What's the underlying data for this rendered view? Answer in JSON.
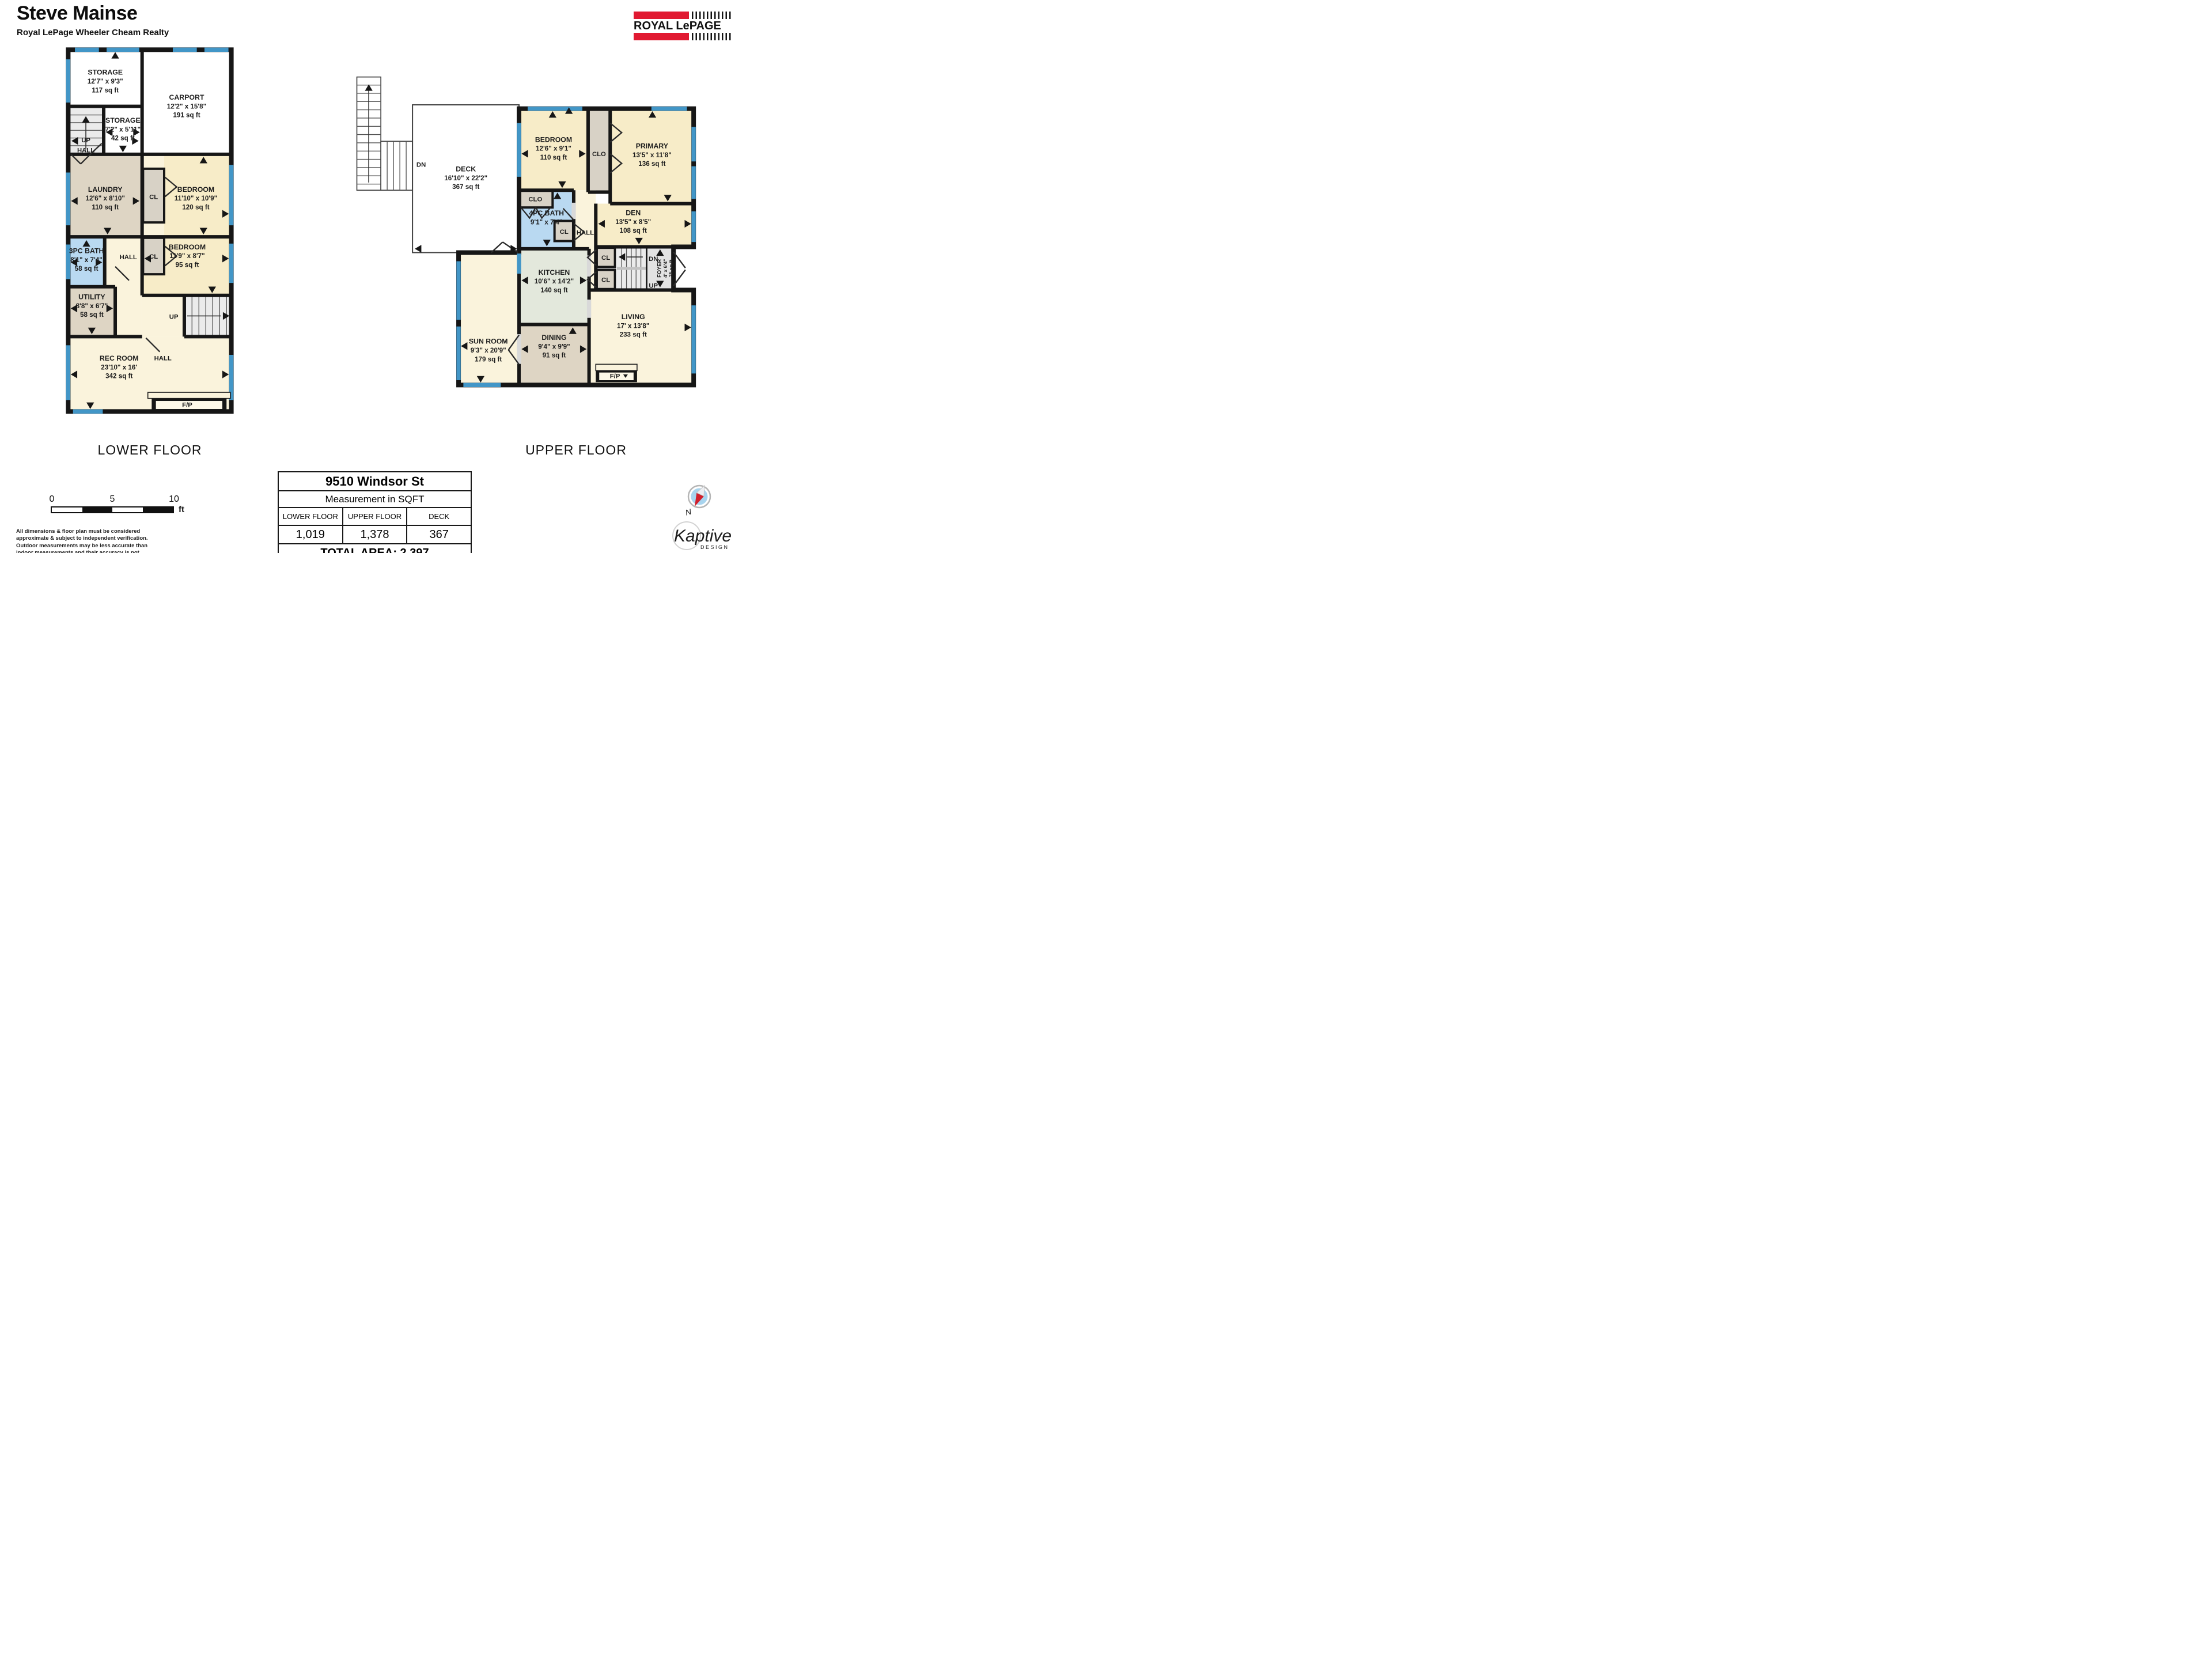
{
  "header": {
    "agent": "Steve Mainse",
    "brokerage": "Royal LePage Wheeler Cheam Realty"
  },
  "brand": {
    "logo": "ROYAL LePAGE",
    "red": "#e11931"
  },
  "lower": {
    "caption": "LOWER FLOOR",
    "storage1": {
      "name": "STORAGE",
      "dims": "12'7\" x 9'3\"",
      "area": "117 sq ft"
    },
    "carport": {
      "name": "CARPORT",
      "dims": "12'2\" x 15'8\"",
      "area": "191 sq ft"
    },
    "storage2": {
      "name": "STORAGE",
      "dims": "7'2\" x 5'11\"",
      "area": "42 sq ft"
    },
    "laundry": {
      "name": "LAUNDRY",
      "dims": "12'6\" x 8'10\"",
      "area": "110 sq ft"
    },
    "bedroom1": {
      "name": "BEDROOM",
      "dims": "11'10\" x 10'9\"",
      "area": "120 sq ft"
    },
    "bath": {
      "name": "3PC BATH",
      "dims": "8'1\" x 7'4\"",
      "area": "58 sq ft"
    },
    "bedroom2": {
      "name": "BEDROOM",
      "dims": "11'9\" x 8'7\"",
      "area": "95 sq ft"
    },
    "utility": {
      "name": "UTILITY",
      "dims": "8'8\" x 6'7\"",
      "area": "58 sq ft"
    },
    "rec": {
      "name": "REC ROOM",
      "dims": "23'10\" x 16'",
      "area": "342 sq ft"
    },
    "up": "UP",
    "hall": "HALL",
    "cl": "CL",
    "fp": "F/P"
  },
  "upper": {
    "caption": "UPPER FLOOR",
    "deck": {
      "name": "DECK",
      "dims": "16'10\" x 22'2\"",
      "area": "367 sq ft"
    },
    "bedroom": {
      "name": "BEDROOM",
      "dims": "12'6\" x 9'1\"",
      "area": "110 sq ft"
    },
    "primary": {
      "name": "PRIMARY",
      "dims": "13'5\" x 11'8\"",
      "area": "136 sq ft"
    },
    "bath": {
      "name": "4PC BATH",
      "dims": "9'1\" x 7'4\""
    },
    "den": {
      "name": "DEN",
      "dims": "13'5\" x 8'5\"",
      "area": "108 sq ft"
    },
    "kitchen": {
      "name": "KITCHEN",
      "dims": "10'6\" x 14'2\"",
      "area": "140 sq ft"
    },
    "sunroom": {
      "name": "SUN ROOM",
      "dims": "9'3\" x 20'9\"",
      "area": "179 sq ft"
    },
    "dining": {
      "name": "DINING",
      "dims": "9'4\" x 9'9\"",
      "area": "91 sq ft"
    },
    "living": {
      "name": "LIVING",
      "dims": "17' x 13'8\"",
      "area": "233 sq ft"
    },
    "foyer": {
      "name": "FOYER",
      "dims": "4' x 6'4\"",
      "area": "25 sq ft"
    },
    "dn": "DN",
    "up": "UP",
    "clo": "CLO",
    "cl": "CL",
    "hall": "HALL",
    "fp": "F/P"
  },
  "table": {
    "address": "9510 Windsor St",
    "subtitle": "Measurement in SQFT",
    "columns": [
      "LOWER FLOOR",
      "UPPER FLOOR",
      "DECK"
    ],
    "values": [
      "1,019",
      "1,378",
      "367"
    ],
    "total": "TOTAL AREA: 2,397"
  },
  "scalebar": {
    "ticks": [
      "0",
      "5",
      "10"
    ],
    "unit": "ft"
  },
  "disclaimer": "All dimensions & floor plan must be considered approximate & subject to independent verification.  Outdoor measurements may be less accurate than indoor measurements and their accuracy is not guaranteed.",
  "compass": {
    "n": "N"
  },
  "watermark": {
    "name": "Kaptive",
    "sub": "DESIGN"
  }
}
